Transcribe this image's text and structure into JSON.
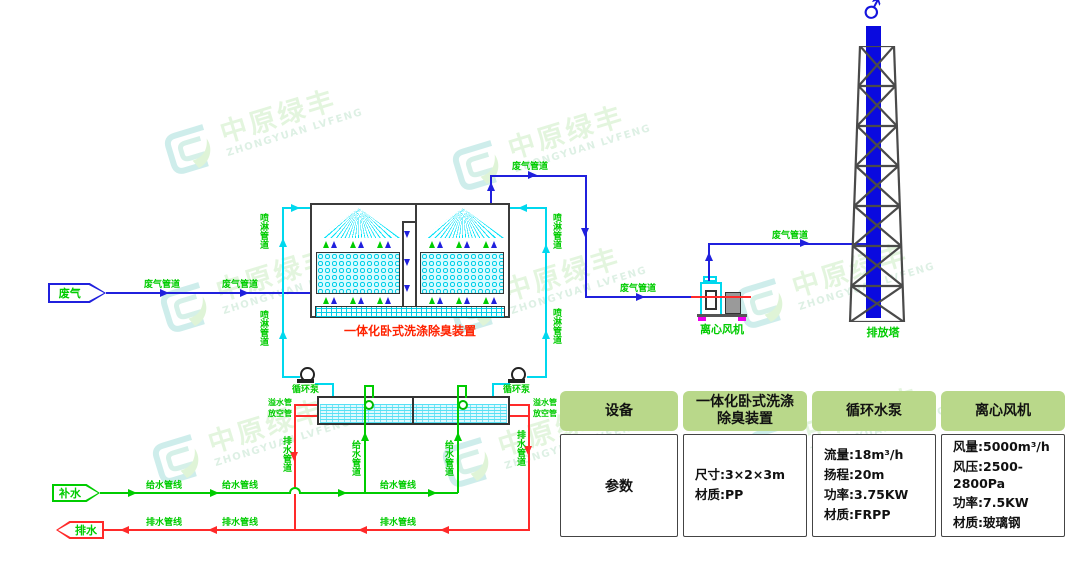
{
  "colors": {
    "gas_pipe_blue": "#2020dd",
    "spray_pipe_cyan": "#00d8ee",
    "water_green": "#00cc00",
    "drain_red": "#ff2a2a",
    "stack_blue": "#0a0adf",
    "table_header_green": "#b9d88a",
    "scrubber_label_red": "#ff2200"
  },
  "watermark": {
    "cn": "中原绿丰",
    "en": "ZHONGYUAN LVFENG"
  },
  "nodes": {
    "waste_gas_in": "废气",
    "makeup_water_in": "补水",
    "drain_out": "排水",
    "scrubber": "一体化卧式洗涤除臭装置",
    "fan": "离心风机",
    "stack_tower": "排放塔",
    "circulation_pump": "循环泵"
  },
  "pipe_labels": {
    "gas": "废气管道",
    "spray": "喷淋管道",
    "supply_line": "给水管线",
    "drain_line": "排水管线",
    "supply_pipe": "给水管道",
    "drain_pipe": "排水管道",
    "overflow_pipe": "溢水管",
    "vent_pipe": "放空管"
  },
  "table": {
    "headers": [
      "设备",
      [
        "一体化卧式洗涤",
        "除臭装置"
      ],
      "循环水泵",
      "离心风机"
    ],
    "row_label": "参数",
    "scrubber_specs": [
      "尺寸:3×2×3m",
      "材质:PP"
    ],
    "pump_specs": [
      "流量:18m³/h",
      "扬程:20m",
      "功率:3.75KW",
      "材质:FRPP"
    ],
    "fan_specs": [
      "风量:5000m³/h",
      "风压:2500-2800Pa",
      "功率:7.5KW",
      "材质:玻璃钢"
    ]
  }
}
